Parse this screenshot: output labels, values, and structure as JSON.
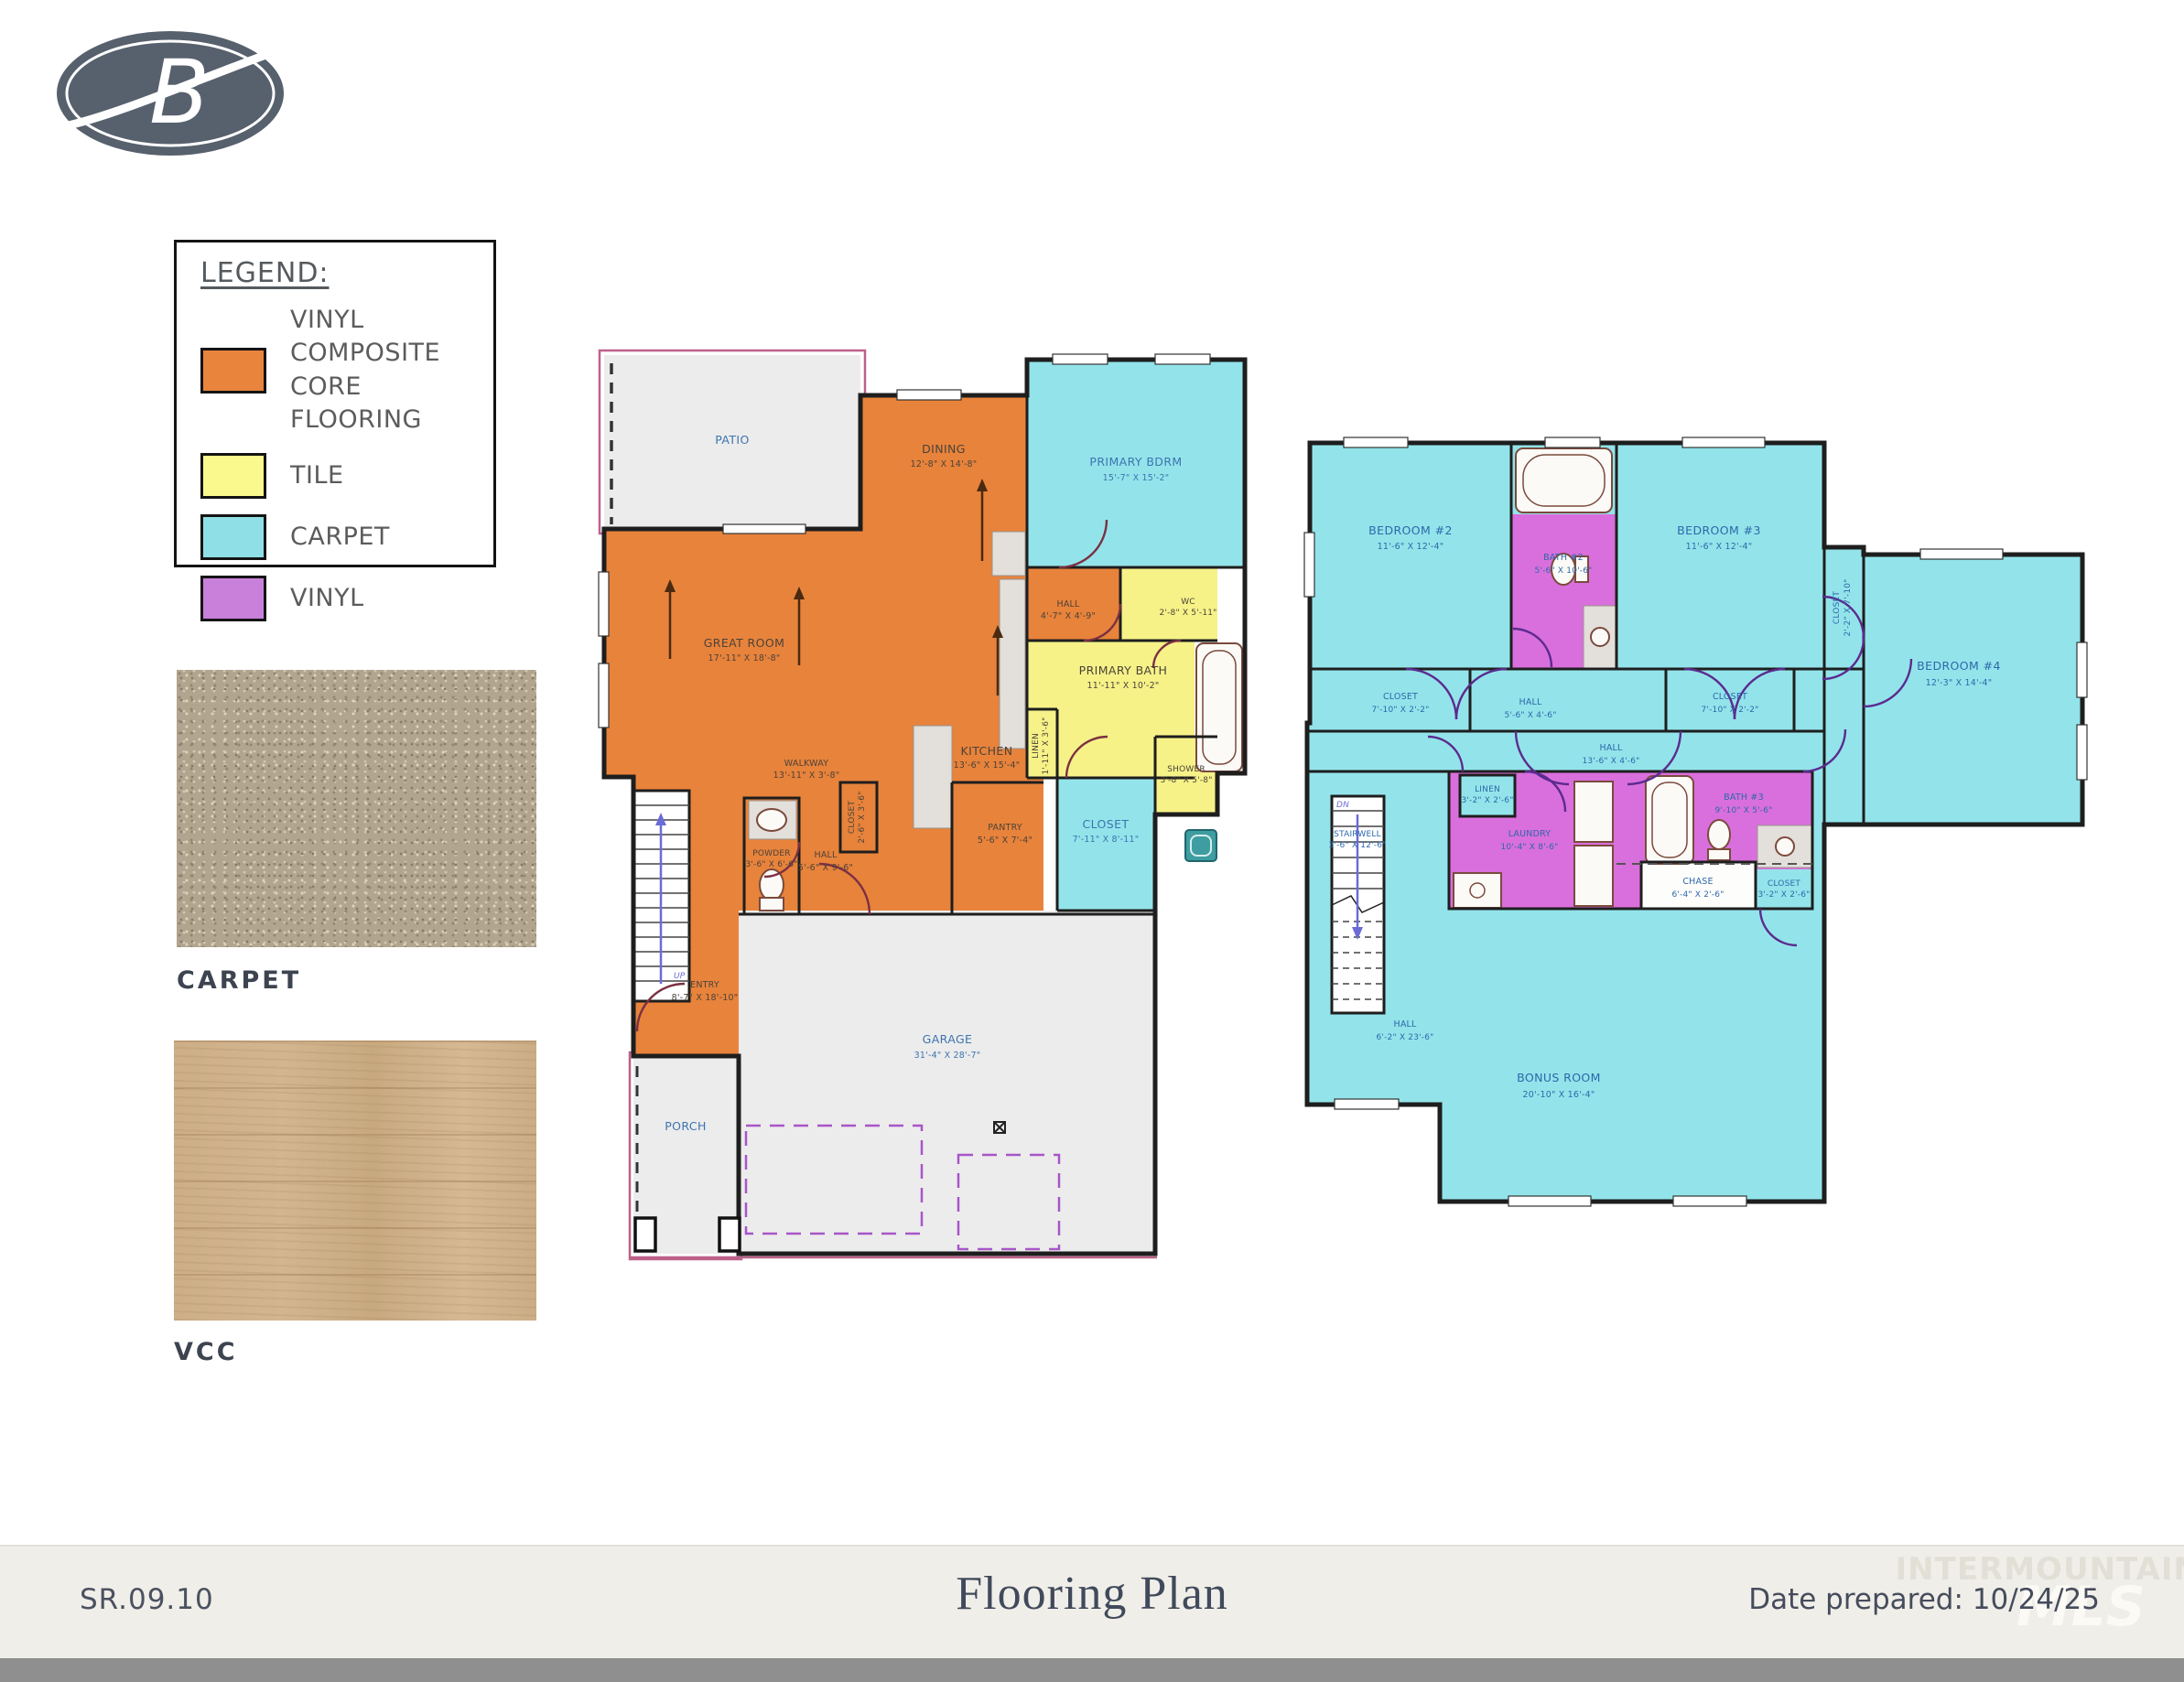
{
  "logo": {
    "letter": "B"
  },
  "legend": {
    "title": "LEGEND:",
    "items": [
      {
        "label": "VINYL COMPOSITE CORE FLOORING",
        "color": "#E8843B"
      },
      {
        "label": "TILE",
        "color": "#FAF98E"
      },
      {
        "label": "CARPET",
        "color": "#8EE0E6"
      },
      {
        "label": "VINYL",
        "color": "#C980DA"
      }
    ]
  },
  "swatches": [
    {
      "caption": "CARPET"
    },
    {
      "caption": "VCC"
    }
  ],
  "floor1": {
    "rooms": [
      {
        "name": "PATIO",
        "dims": ""
      },
      {
        "name": "DINING",
        "dims": "12'-8\" X 14'-8\""
      },
      {
        "name": "PRIMARY BDRM",
        "dims": "15'-7\" X 15'-2\""
      },
      {
        "name": "GREAT ROOM",
        "dims": "17'-11\" X 18'-8\""
      },
      {
        "name": "KITCHEN",
        "dims": "13'-6\" X 15'-4\""
      },
      {
        "name": "WALKWAY",
        "dims": "13'-11\" X 3'-8\""
      },
      {
        "name": "HALL",
        "dims": "4'-7\" X 4'-9\""
      },
      {
        "name": "WC",
        "dims": "2'-8\" X 5'-11\""
      },
      {
        "name": "PRIMARY BATH",
        "dims": "11'-11\" X 10'-2\""
      },
      {
        "name": "LINEN",
        "dims": "1'-11\" X 3'-6\""
      },
      {
        "name": "CLOSET",
        "dims": "7'-11\" X 8'-11\""
      },
      {
        "name": "SHOWER",
        "dims": "3'-8\" X 5'-8\""
      },
      {
        "name": "PANTRY",
        "dims": "5'-6\" X 7'-4\""
      },
      {
        "name": "POWDER",
        "dims": "3'-6\" X 6'-6\""
      },
      {
        "name": "HALL",
        "dims": "5'-6\" X 9'-6\""
      },
      {
        "name": "CLOSET",
        "dims": "2'-6\" X 3'-6\""
      },
      {
        "name": "ENTRY",
        "dims": "8'-7\" X 18'-10\""
      },
      {
        "name": "GARAGE",
        "dims": "31'-4\" X 28'-7\""
      },
      {
        "name": "PORCH",
        "dims": ""
      },
      {
        "name": "UP",
        "dims": ""
      }
    ]
  },
  "floor2": {
    "rooms": [
      {
        "name": "BEDROOM #2",
        "dims": "11'-6\" X 12'-4\""
      },
      {
        "name": "BATH #2",
        "dims": "5'-6\" X 10'-6\""
      },
      {
        "name": "BEDROOM #3",
        "dims": "11'-6\" X 12'-4\""
      },
      {
        "name": "CLOSET",
        "dims": "7'-10\" X 2'-2\""
      },
      {
        "name": "HALL",
        "dims": "5'-6\" X 4'-6\""
      },
      {
        "name": "CLOSET",
        "dims": "7'-10\" X 2'-2\""
      },
      {
        "name": "CLOSET",
        "dims": "2'-2\" X 7'-10\""
      },
      {
        "name": "BEDROOM #4",
        "dims": "12'-3\" X 14'-4\""
      },
      {
        "name": "HALL",
        "dims": "13'-6\" X 4'-6\""
      },
      {
        "name": "LINEN",
        "dims": "3'-2\" X 2'-6\""
      },
      {
        "name": "LAUNDRY",
        "dims": "10'-4\" X 8'-6\""
      },
      {
        "name": "BATH #3",
        "dims": "9'-10\" X 5'-6\""
      },
      {
        "name": "CHASE",
        "dims": "6'-4\" X 2'-6\""
      },
      {
        "name": "CLOSET",
        "dims": "3'-2\" X 2'-6\""
      },
      {
        "name": "STAIRWELL",
        "dims": "3'-6\" X 12'-6\""
      },
      {
        "name": "HALL",
        "dims": "6'-2\" X 23'-6\""
      },
      {
        "name": "BONUS ROOM",
        "dims": "20'-10\" X 16'-4\""
      },
      {
        "name": "DN",
        "dims": ""
      }
    ]
  },
  "footer": {
    "sheet_number": "SR.09.10",
    "title": "Flooring Plan",
    "date_prepared": "Date prepared: 10/24/25"
  },
  "watermark": {
    "line1": "INTERMOUNTAIN",
    "line2": "MLS"
  },
  "colors": {
    "plan_orange": "#E8833B",
    "plan_yellow": "#F6F288",
    "plan_cyan": "#93E4EA",
    "plan_vinyl": "#D96FDC",
    "plan_gray": "#ececec",
    "logo": "#57606d",
    "footer_bg": "#f0eee8",
    "label_blue": "#3c74b0",
    "teal_fixture": "#3d9da0"
  }
}
